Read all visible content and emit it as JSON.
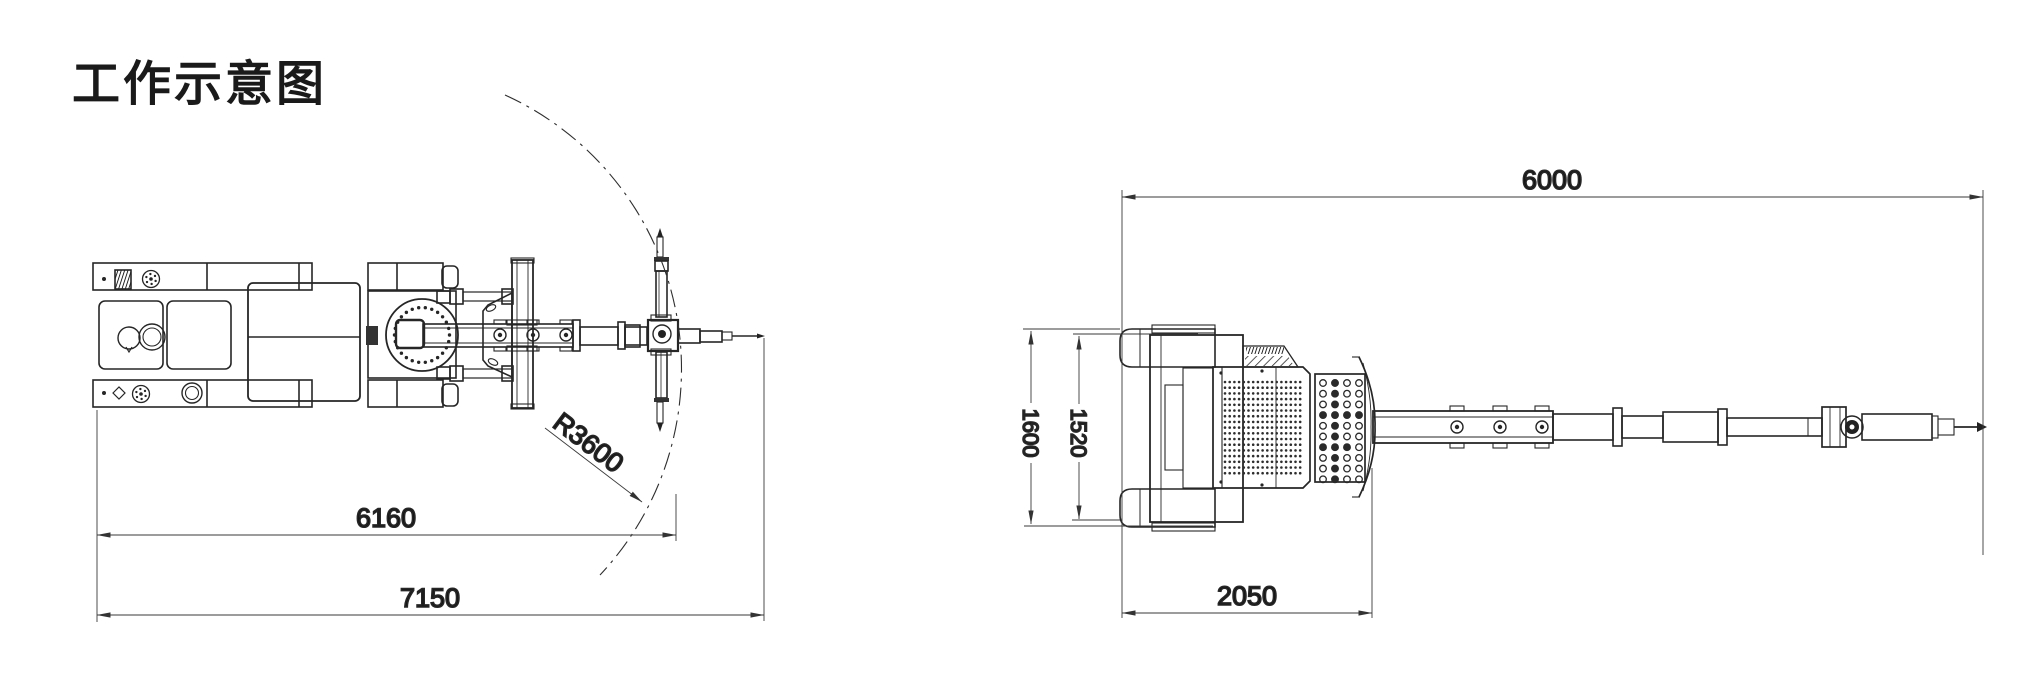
{
  "title": "工作示意图",
  "left_view": {
    "description": "plan view of drilling rig with slewing arc",
    "dims": {
      "radius": "R3600",
      "reach": "6160",
      "overall": "7150"
    }
  },
  "right_view": {
    "description": "longitudinal view of drilling rig",
    "dims": {
      "overall_length": "6000",
      "outer_width": "1600",
      "track_width": "1520",
      "carrier_length": "2050"
    }
  },
  "colors": {
    "background": "#ffffff",
    "machine_line": "#262626",
    "dimension_line": "#3a3a3a",
    "text": "#111111"
  }
}
